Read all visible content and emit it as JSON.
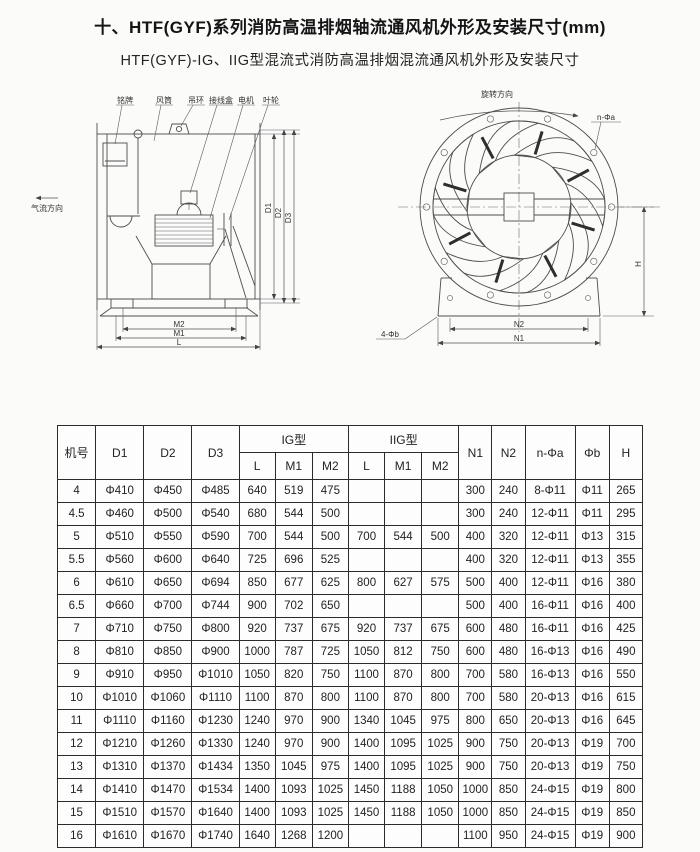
{
  "page": {
    "title": "十、HTF(GYF)系列消防高温排烟轴流通风机外形及安装尺寸(mm)",
    "subtitle": "HTF(GYF)-IG、IIG型混流式消防高温排烟混流通风机外形及安装尺寸"
  },
  "side_view": {
    "part_labels": {
      "nameplate": "铭牌",
      "duct": "风筒",
      "lifting_ring": "吊环",
      "junction_box": "接线盒",
      "motor": "电机",
      "impeller": "叶轮"
    },
    "airflow_label": "气流方向",
    "dim_d1": "D1",
    "dim_d2": "D2",
    "dim_d3": "D3",
    "dim_m2": "M2",
    "dim_m1": "M1",
    "dim_l": "L"
  },
  "front_view": {
    "rotation_label": "旋转方向",
    "bolt_holes_label": "n-Φa",
    "foot_holes_label": "4-Φb",
    "dim_h": "H",
    "dim_n2": "N2",
    "dim_n1": "N1"
  },
  "table": {
    "headers": {
      "machine_no": "机号",
      "d1": "D1",
      "d2": "D2",
      "d3": "D3",
      "ig_group": "IG型",
      "iig_group": "IIG型",
      "l": "L",
      "m1": "M1",
      "m2": "M2",
      "n1": "N1",
      "n2": "N2",
      "n_phi_a": "n-Φa",
      "phi_b": "Φb",
      "h": "H"
    },
    "rows": [
      [
        "4",
        "Φ410",
        "Φ450",
        "Φ485",
        "640",
        "519",
        "475",
        "",
        "",
        "",
        "300",
        "240",
        "8-Φ11",
        "Φ11",
        "265"
      ],
      [
        "4.5",
        "Φ460",
        "Φ500",
        "Φ540",
        "680",
        "544",
        "500",
        "",
        "",
        "",
        "300",
        "240",
        "12-Φ11",
        "Φ11",
        "295"
      ],
      [
        "5",
        "Φ510",
        "Φ550",
        "Φ590",
        "700",
        "544",
        "500",
        "700",
        "544",
        "500",
        "400",
        "320",
        "12-Φ11",
        "Φ13",
        "315"
      ],
      [
        "5.5",
        "Φ560",
        "Φ600",
        "Φ640",
        "725",
        "696",
        "525",
        "",
        "",
        "",
        "400",
        "320",
        "12-Φ11",
        "Φ13",
        "355"
      ],
      [
        "6",
        "Φ610",
        "Φ650",
        "Φ694",
        "850",
        "677",
        "625",
        "800",
        "627",
        "575",
        "500",
        "400",
        "12-Φ11",
        "Φ16",
        "380"
      ],
      [
        "6.5",
        "Φ660",
        "Φ700",
        "Φ744",
        "900",
        "702",
        "650",
        "",
        "",
        "",
        "500",
        "400",
        "16-Φ11",
        "Φ16",
        "400"
      ],
      [
        "7",
        "Φ710",
        "Φ750",
        "Φ800",
        "920",
        "737",
        "675",
        "920",
        "737",
        "675",
        "600",
        "480",
        "16-Φ11",
        "Φ16",
        "425"
      ],
      [
        "8",
        "Φ810",
        "Φ850",
        "Φ900",
        "1000",
        "787",
        "725",
        "1050",
        "812",
        "750",
        "600",
        "480",
        "16-Φ13",
        "Φ16",
        "490"
      ],
      [
        "9",
        "Φ910",
        "Φ950",
        "Φ1010",
        "1050",
        "820",
        "750",
        "1100",
        "870",
        "800",
        "700",
        "580",
        "16-Φ13",
        "Φ16",
        "550"
      ],
      [
        "10",
        "Φ1010",
        "Φ1060",
        "Φ1110",
        "1100",
        "870",
        "800",
        "1100",
        "870",
        "800",
        "700",
        "580",
        "20-Φ13",
        "Φ16",
        "615"
      ],
      [
        "11",
        "Φ1110",
        "Φ1160",
        "Φ1230",
        "1240",
        "970",
        "900",
        "1340",
        "1045",
        "975",
        "800",
        "650",
        "20-Φ13",
        "Φ16",
        "645"
      ],
      [
        "12",
        "Φ1210",
        "Φ1260",
        "Φ1330",
        "1240",
        "970",
        "900",
        "1400",
        "1095",
        "1025",
        "900",
        "750",
        "20-Φ13",
        "Φ19",
        "700"
      ],
      [
        "13",
        "Φ1310",
        "Φ1370",
        "Φ1434",
        "1350",
        "1045",
        "975",
        "1400",
        "1095",
        "1025",
        "900",
        "750",
        "20-Φ13",
        "Φ19",
        "750"
      ],
      [
        "14",
        "Φ1410",
        "Φ1470",
        "Φ1534",
        "1400",
        "1093",
        "1025",
        "1450",
        "1188",
        "1050",
        "1000",
        "850",
        "24-Φ15",
        "Φ19",
        "800"
      ],
      [
        "15",
        "Φ1510",
        "Φ1570",
        "Φ1640",
        "1400",
        "1093",
        "1025",
        "1450",
        "1188",
        "1050",
        "1000",
        "850",
        "24-Φ15",
        "Φ19",
        "850"
      ],
      [
        "16",
        "Φ1610",
        "Φ1670",
        "Φ1740",
        "1640",
        "1268",
        "1200",
        "",
        "",
        "",
        "1100",
        "950",
        "24-Φ15",
        "Φ19",
        "900"
      ]
    ]
  }
}
